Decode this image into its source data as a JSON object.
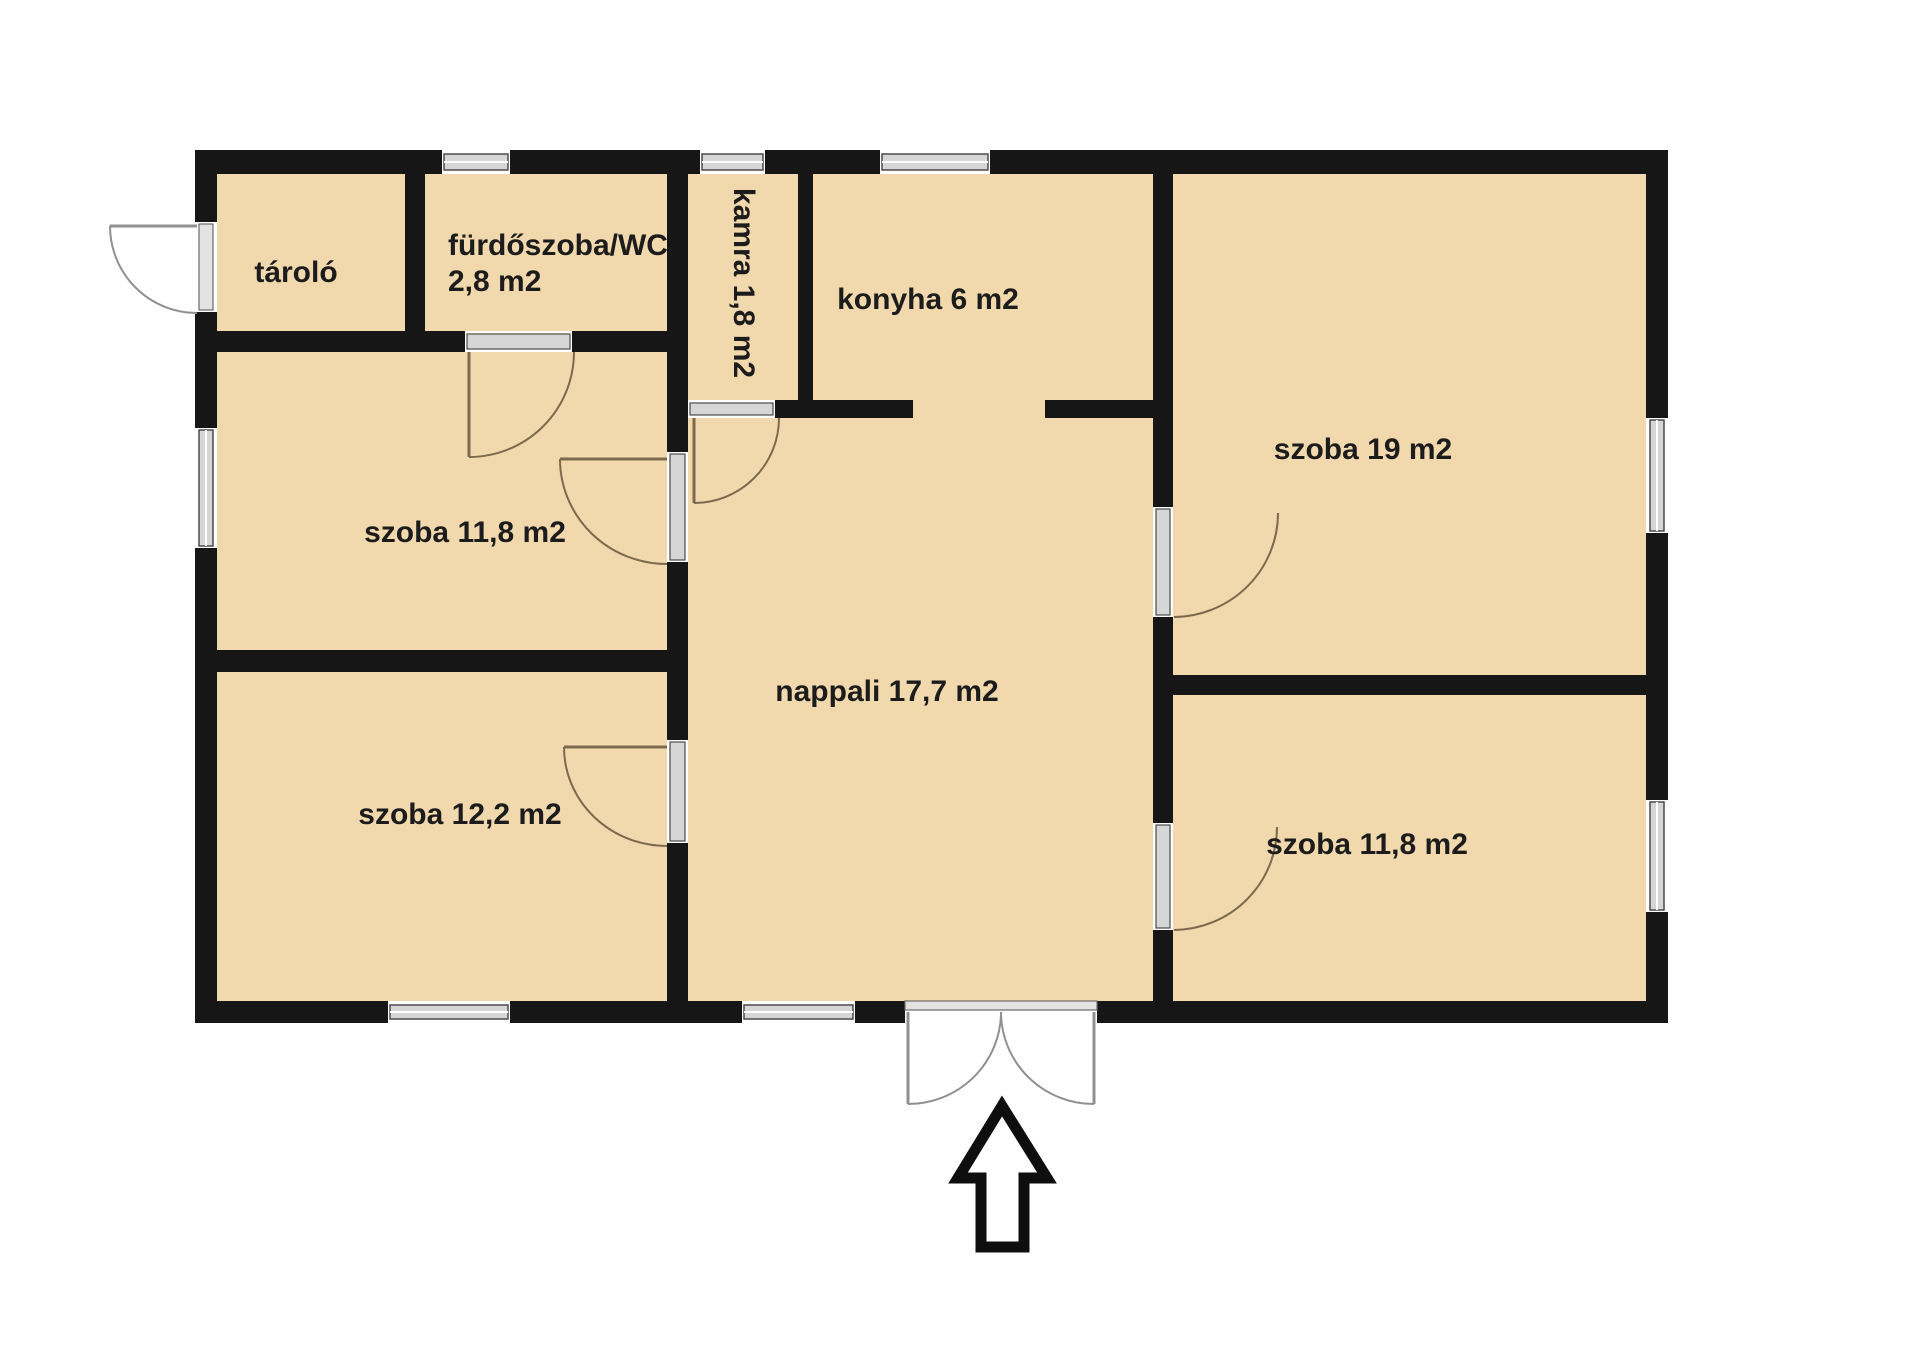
{
  "page": {
    "background": "#ffffff"
  },
  "colors": {
    "room_fill": "#f2d9ad",
    "wall": "#161616",
    "window_glass": "#d6d6d6",
    "window_frame": "#4a4a4a",
    "interior_door_arc": "#7b6a4e",
    "exterior_door_arc": "#909090",
    "arrow_outline": "#0e0e0e",
    "label_text": "#1c1c1c"
  },
  "rooms": [
    {
      "id": "tarolo",
      "label": "tároló"
    },
    {
      "id": "furdoszoba-wc",
      "label": "fürdőszoba/WC",
      "area": "2,8 m2"
    },
    {
      "id": "kamra",
      "label": "kamra 1,8 m2"
    },
    {
      "id": "konyha",
      "label": "konyha 6 m2"
    },
    {
      "id": "szoba-19",
      "label": "szoba 19 m2"
    },
    {
      "id": "szoba-118-left",
      "label": "szoba 11,8 m2"
    },
    {
      "id": "nappali",
      "label": "nappali 17,7 m2"
    },
    {
      "id": "szoba-122",
      "label": "szoba 12,2 m2"
    },
    {
      "id": "szoba-118-right",
      "label": "szoba 11,8 m2"
    }
  ]
}
